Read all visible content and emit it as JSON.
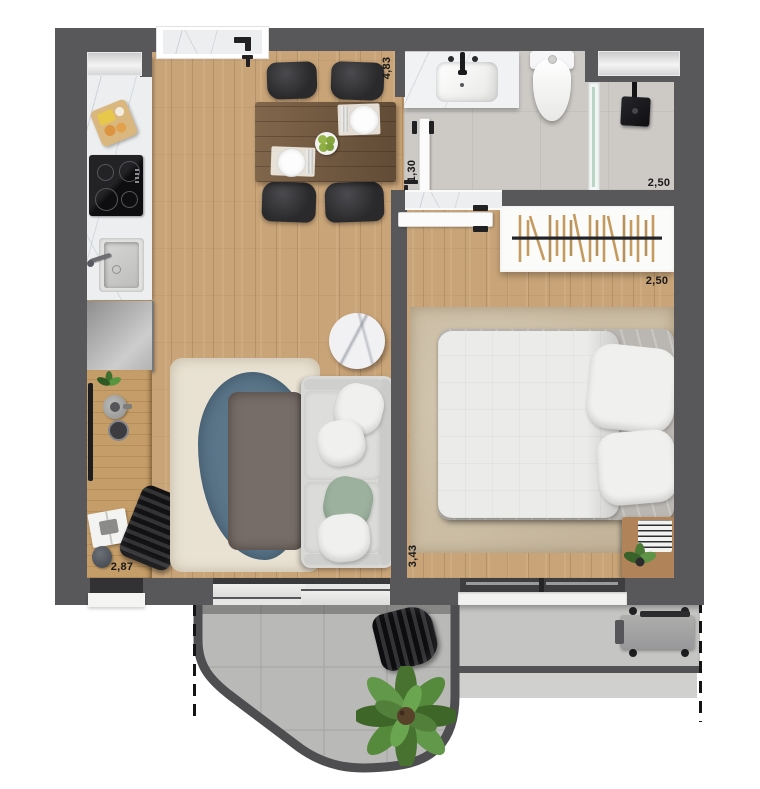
{
  "plan": {
    "name": "apartment-floor-plan"
  },
  "dimensions": {
    "living_length": "4,83",
    "bathroom_entry": "1,30",
    "bathroom_width": "2,50",
    "closet_width": "2,50",
    "bedroom_length": "3,43",
    "living_width": "2,87"
  },
  "palette": {
    "wall": "#58585a",
    "floor_wood": "#c9a478",
    "desk_wood": "#c59d68",
    "table_wood": "#6f563e",
    "bath_floor": "#cdcac6",
    "balcony_tile": "#b9b9b7",
    "ledge": "#c5c5c3",
    "walkway": "#d0d0ce",
    "marble": "#eceef0",
    "sofa": "#d8d8d6",
    "rug_cream": "#e9e2d3",
    "rug_blue": "#5b7589",
    "rug_brown": "#776d68",
    "rug_bedroom": "#cbbda4",
    "chair": "#2a2a2c",
    "pillow_green": "#9cb29e",
    "plant_green": "#4f7d38",
    "label": "#191919"
  }
}
